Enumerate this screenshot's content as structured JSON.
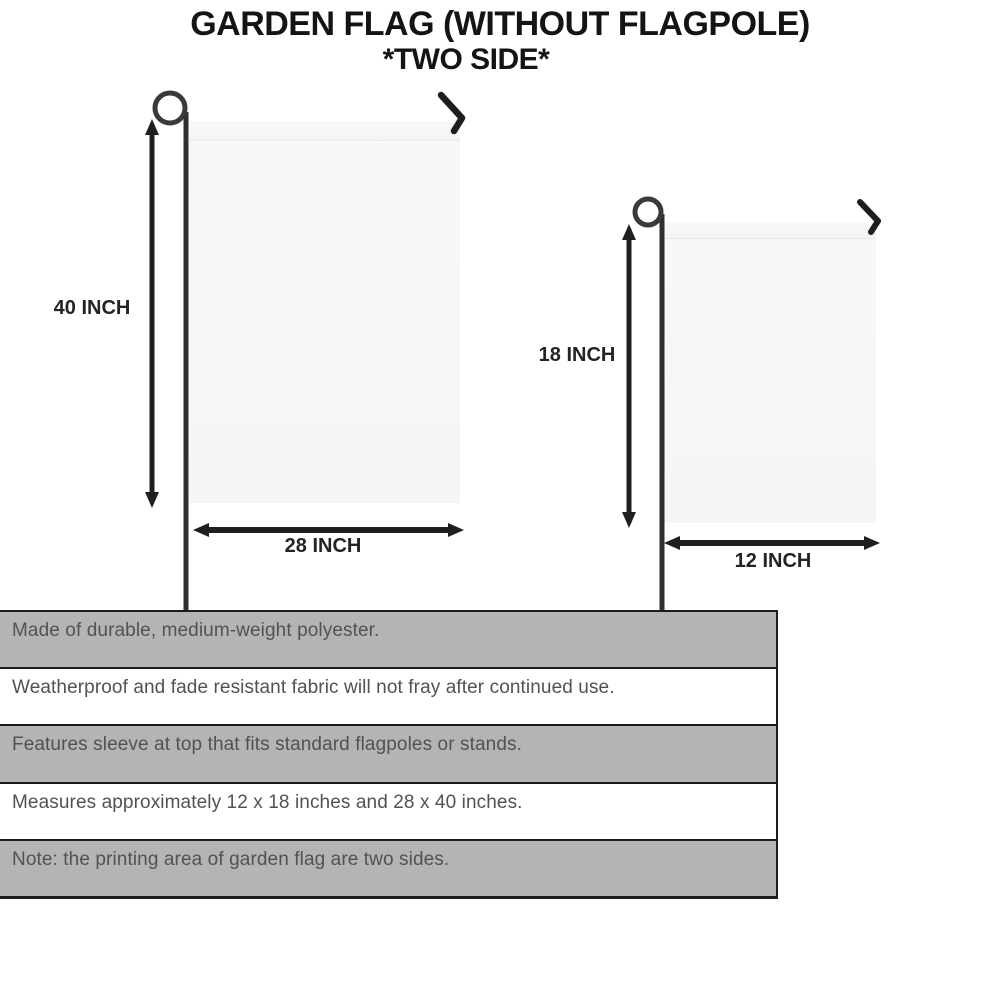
{
  "title": {
    "line1": "GARDEN FLAG (WITHOUT FLAGPOLE)",
    "line2": "*TWO SIDE*"
  },
  "flags": {
    "large": {
      "height_label": "40 INCH",
      "width_label": "28 INCH"
    },
    "small": {
      "height_label": "18 INCH",
      "width_label": "12 INCH"
    }
  },
  "features": [
    "Made of durable, medium-weight polyester.",
    "Weatherproof and fade resistant fabric will not fray after continued use.",
    "Features sleeve at top that fits standard flagpoles or stands.",
    "Measures approximately 12 x 18 inches and 28 x 40 inches.",
    "Note: the printing area of garden flag are two sides."
  ],
  "colors": {
    "row_gray": "#b4b4b4",
    "row_white": "#ffffff",
    "border_black": "#1c1c1c",
    "feature_text": "#515257",
    "title_text": "#141414",
    "flag_fill": "#f6f6f8",
    "pole": "#353535"
  }
}
